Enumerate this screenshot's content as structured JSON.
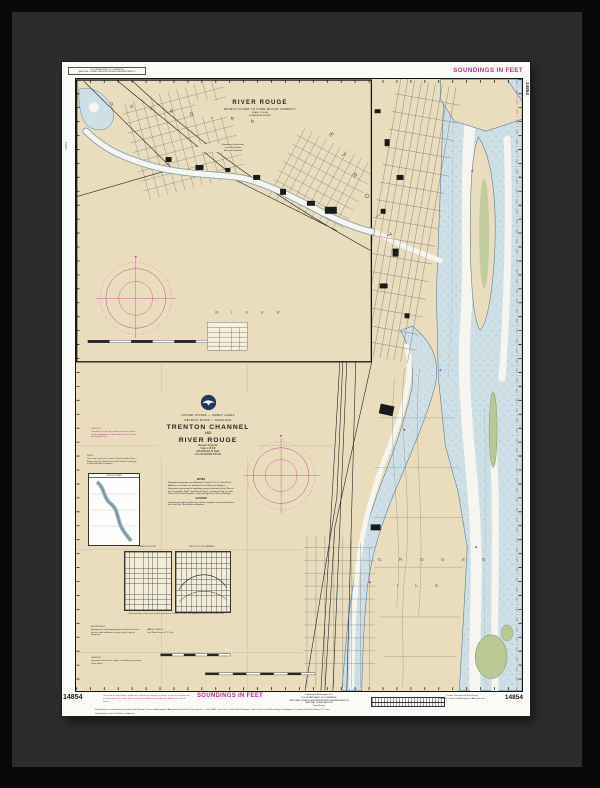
{
  "margin": {
    "agency_box": "U.S. DEPARTMENT OF COMMERCE\nNATIONAL OCEANIC AND ATMOSPHERIC ADMINISTRATION",
    "top_soundings": "SOUNDINGS IN FEET",
    "right_vertical_number": "14854",
    "left_vertical_number": "14854",
    "bottom": {
      "left_number": "14854",
      "magenta_note": "Corrected through Notices to Mariners. Temporary changes or defects in aids to navigation are not indicated on this chart. See Local Notice to Mariners issued by the Ninth Coast Guard District.",
      "soundings": "SOUNDINGS IN FEET",
      "publisher": "Published at Washington, D.C.\nU.S. DEPARTMENT OF COMMERCE\nNATIONAL OCEANIC AND ATMOSPHERIC ADMINISTRATION\nNATIONAL OCEAN SERVICE\nCoast Survey",
      "right_title": "Trenton Channel and River Rouge\nNational Oceanic and Atmospheric Administration",
      "right_number": "14854",
      "footnote1": "Produced from a reproducible furnished by the National Oceanic and Atmospheric Administration, National Ocean Service — chart 14854, Great Lakes, Detroit River, Michigan, Trenton Channel and River Rouge. Soundings in feet below Low Water Datum 571.7 feet.",
      "footnote2": "Lithographed in the United States of America."
    }
  },
  "inset": {
    "title": "RIVER ROUGE",
    "subtitle": "DETROIT RIVER TO FORD MOTOR COMPANY",
    "scale_line": "SCALE 1:15,000",
    "soundings_line": "SOUNDINGS IN FEET",
    "note": "Soundings in feet below\nLow Water Datum\nMercator Projection",
    "label_dearborn": "D E A R B O R N",
    "label_detroit": "D E T R O I T",
    "label_river": "R I V E R"
  },
  "title_block": {
    "region": "UNITED STATES — GREAT LAKES",
    "subregion": "DETROIT RIVER — MICHIGAN",
    "title_line1": "TRENTON CHANNEL",
    "title_line2": "AND",
    "title_line3": "RIVER ROUGE",
    "projection": "Mercator Projection",
    "scale": "Scale 1:15,000",
    "datum1": "SOUNDINGS IN FEET",
    "datum2": "AT LOW WATER DATUM"
  },
  "notes": {
    "heading": "NOTES",
    "body": "Navigation regulations are published in Chapter 2, U.S. Coast Pilot 6. Additions or revisions are published in the Notices to Mariners. Information concerning the regulations may be obtained at the Office of the Commander, Ninth Coast Guard District, Cleveland, Ohio, or at the Office of the District Engineer, Corps of Engineers, Detroit, Michigan.",
    "caution_heading": "CAUTION",
    "caution_body": "Temporary changes or defects in aids to navigation are not indicated on this chart. See Local Notice to Mariners."
  },
  "side_blocks": {
    "radio_caution": "CAUTION\nLimitations on the use of radio signals as aids to marine navigation can be found in the U.S. Coast Guard Light Lists.",
    "coverage_note": "NOTE\nThis chart covers the Trenton Channel and the River Rouge from the Detroit River to the head of navigation at the Ford Motor Company.",
    "index_map_title": "DETROIT RIVER",
    "authorities": "AUTHORITIES\nHydrography and topography by the National Ocean Service, with additional surveys by the Corps of Engineers.",
    "water_levels": "WATER LEVELS\nLow Water Datum 571.7 feet.",
    "shoaling_caution": "CAUTION\nImproved channels are subject to shoaling, particularly at the edges.",
    "diagram_left_title": "LINES OF FLOW",
    "diagram_right_title": "VELOCITY OF CURRENT",
    "diagram_caption": "Observed lines of flow and current velocities in Trenton Channel and adjacent waters of the Detroit River."
  },
  "map_labels": {
    "grosse": "G R O S S E",
    "ile": "I L E"
  }
}
